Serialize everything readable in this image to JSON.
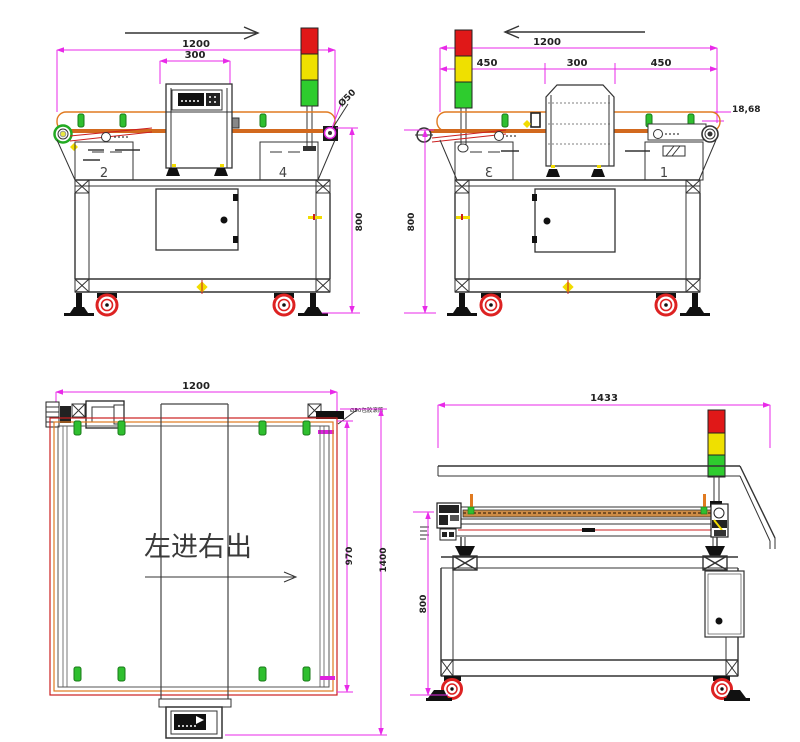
{
  "drawing_type": "metal-detector-conveyor-engineering-drawing",
  "colors": {
    "dimension_line": "#e82ae8",
    "belt_orange": "#d2691e",
    "belt_outline": "#e07a20",
    "line_dark": "#333333",
    "accent_red": "#cc2020",
    "clip_green": "#2fbf2f",
    "mark_yellow": "#f2dc00",
    "tower_red": "#e01818",
    "tower_yellow": "#efe000",
    "tower_green": "#2ecc2e",
    "caster_red": "#dd2222"
  },
  "views": {
    "side_left": {
      "dim_length": "1200",
      "dim_detector": "300",
      "dim_height": "800",
      "roller_dia": "Ø50",
      "panel_left": "2",
      "panel_right": "4"
    },
    "side_right": {
      "dim_length": "1200",
      "dim_infeed": "450",
      "dim_detector": "300",
      "dim_outfeed": "450",
      "dim_belt_offset": "18,68",
      "dim_height": "800",
      "panel_left": "3",
      "panel_right": "1"
    },
    "top": {
      "dim_length": "1200",
      "dim_belt_width": "970",
      "dim_overall_width": "1400",
      "flow_note": "左进右出",
      "roller_note": "Ø50包胶滚筒"
    },
    "front": {
      "dim_length": "1433",
      "dim_height": "800"
    }
  }
}
